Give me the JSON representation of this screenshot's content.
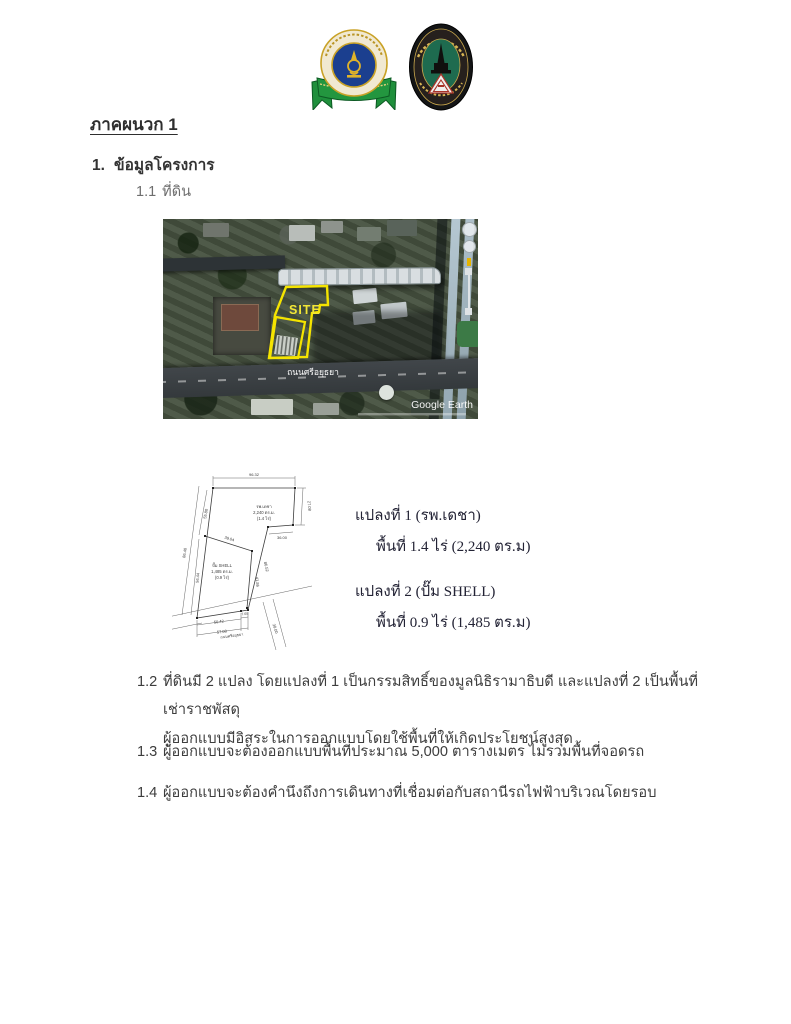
{
  "header": {
    "left_logo": "mahidol-university-emblem",
    "right_logo": "association-of-siamese-architects-emblem"
  },
  "headings": {
    "appendix_title": "ภาคผนวก 1",
    "item1_num": "1.",
    "item1_label": "ข้อมูลโครงการ",
    "item11_num": "1.1",
    "item11_label": "ที่ดิน"
  },
  "map": {
    "site_label": "SITE",
    "road_label": "ถนนศรีอยุธยา",
    "watermark": "Google Earth"
  },
  "diagram": {
    "dims": {
      "top": "96.32",
      "right_v": "27.08",
      "right_h": "36.00",
      "left_outer": "86.40",
      "left_upper": "55.80",
      "left_lower": "56.44",
      "divider": "39.04",
      "plot2_right": "41.86",
      "plot1_slant": "86.52",
      "bottom_a": "50.42",
      "bottom_b": "7.65",
      "bottom_total": "57.08",
      "side_road": "38.00"
    },
    "plot1": {
      "line1": "รพ.เดชา",
      "line2": "2,240 ตร.ม.",
      "line3": "(1.4 ไร่)"
    },
    "plot2": {
      "line1": "ปั๊ม SHELL",
      "line2": "1,485 ตร.ม.",
      "line3": "(0.9 ไร่)"
    },
    "road_label": "ถนนศรีอยุธยา"
  },
  "plots_text": {
    "plot1_title": "แปลงที่ 1   (รพ.เดชา)",
    "plot1_area": "พื้นที่ 1.4 ไร่  (2,240 ตร.ม)",
    "plot2_title": "แปลงที่ 2  (ปั๊ม SHELL)",
    "plot2_area": "พื้นที่ 0.9 ไร่ (1,485 ตร.ม)"
  },
  "items": {
    "i12_num": "1.2",
    "i12_line1": "ที่ดินมี 2 แปลง โดยแปลงที่ 1 เป็นกรรมสิทธิ์ของมูลนิธิรามาธิบดี และแปลงที่ 2 เป็นพื้นที่เช่าราชพัสดุ",
    "i12_line2": "ผู้ออกแบบมีอิสระในการออกแบบโดยใช้พื้นที่ให้เกิดประโยชน์สูงสุด",
    "i13_num": "1.3",
    "i13_text": "ผู้ออกแบบจะต้องออกแบบพื้นที่ประมาณ 5,000 ตารางเมตร ไม่รวมพื้นที่จอดรถ",
    "i14_num": "1.4",
    "i14_text": "ผู้ออกแบบจะต้องคำนึงถึงการเดินทางที่เชื่อมต่อกับสถานีรถไฟฟ้าบริเวณโดยรอบ"
  },
  "colors": {
    "site_outline": "#f5e400",
    "ribbon_green": "#1f8f3c",
    "emblem_blue": "#1b3f8f",
    "asa_green": "#1e6b4f"
  }
}
